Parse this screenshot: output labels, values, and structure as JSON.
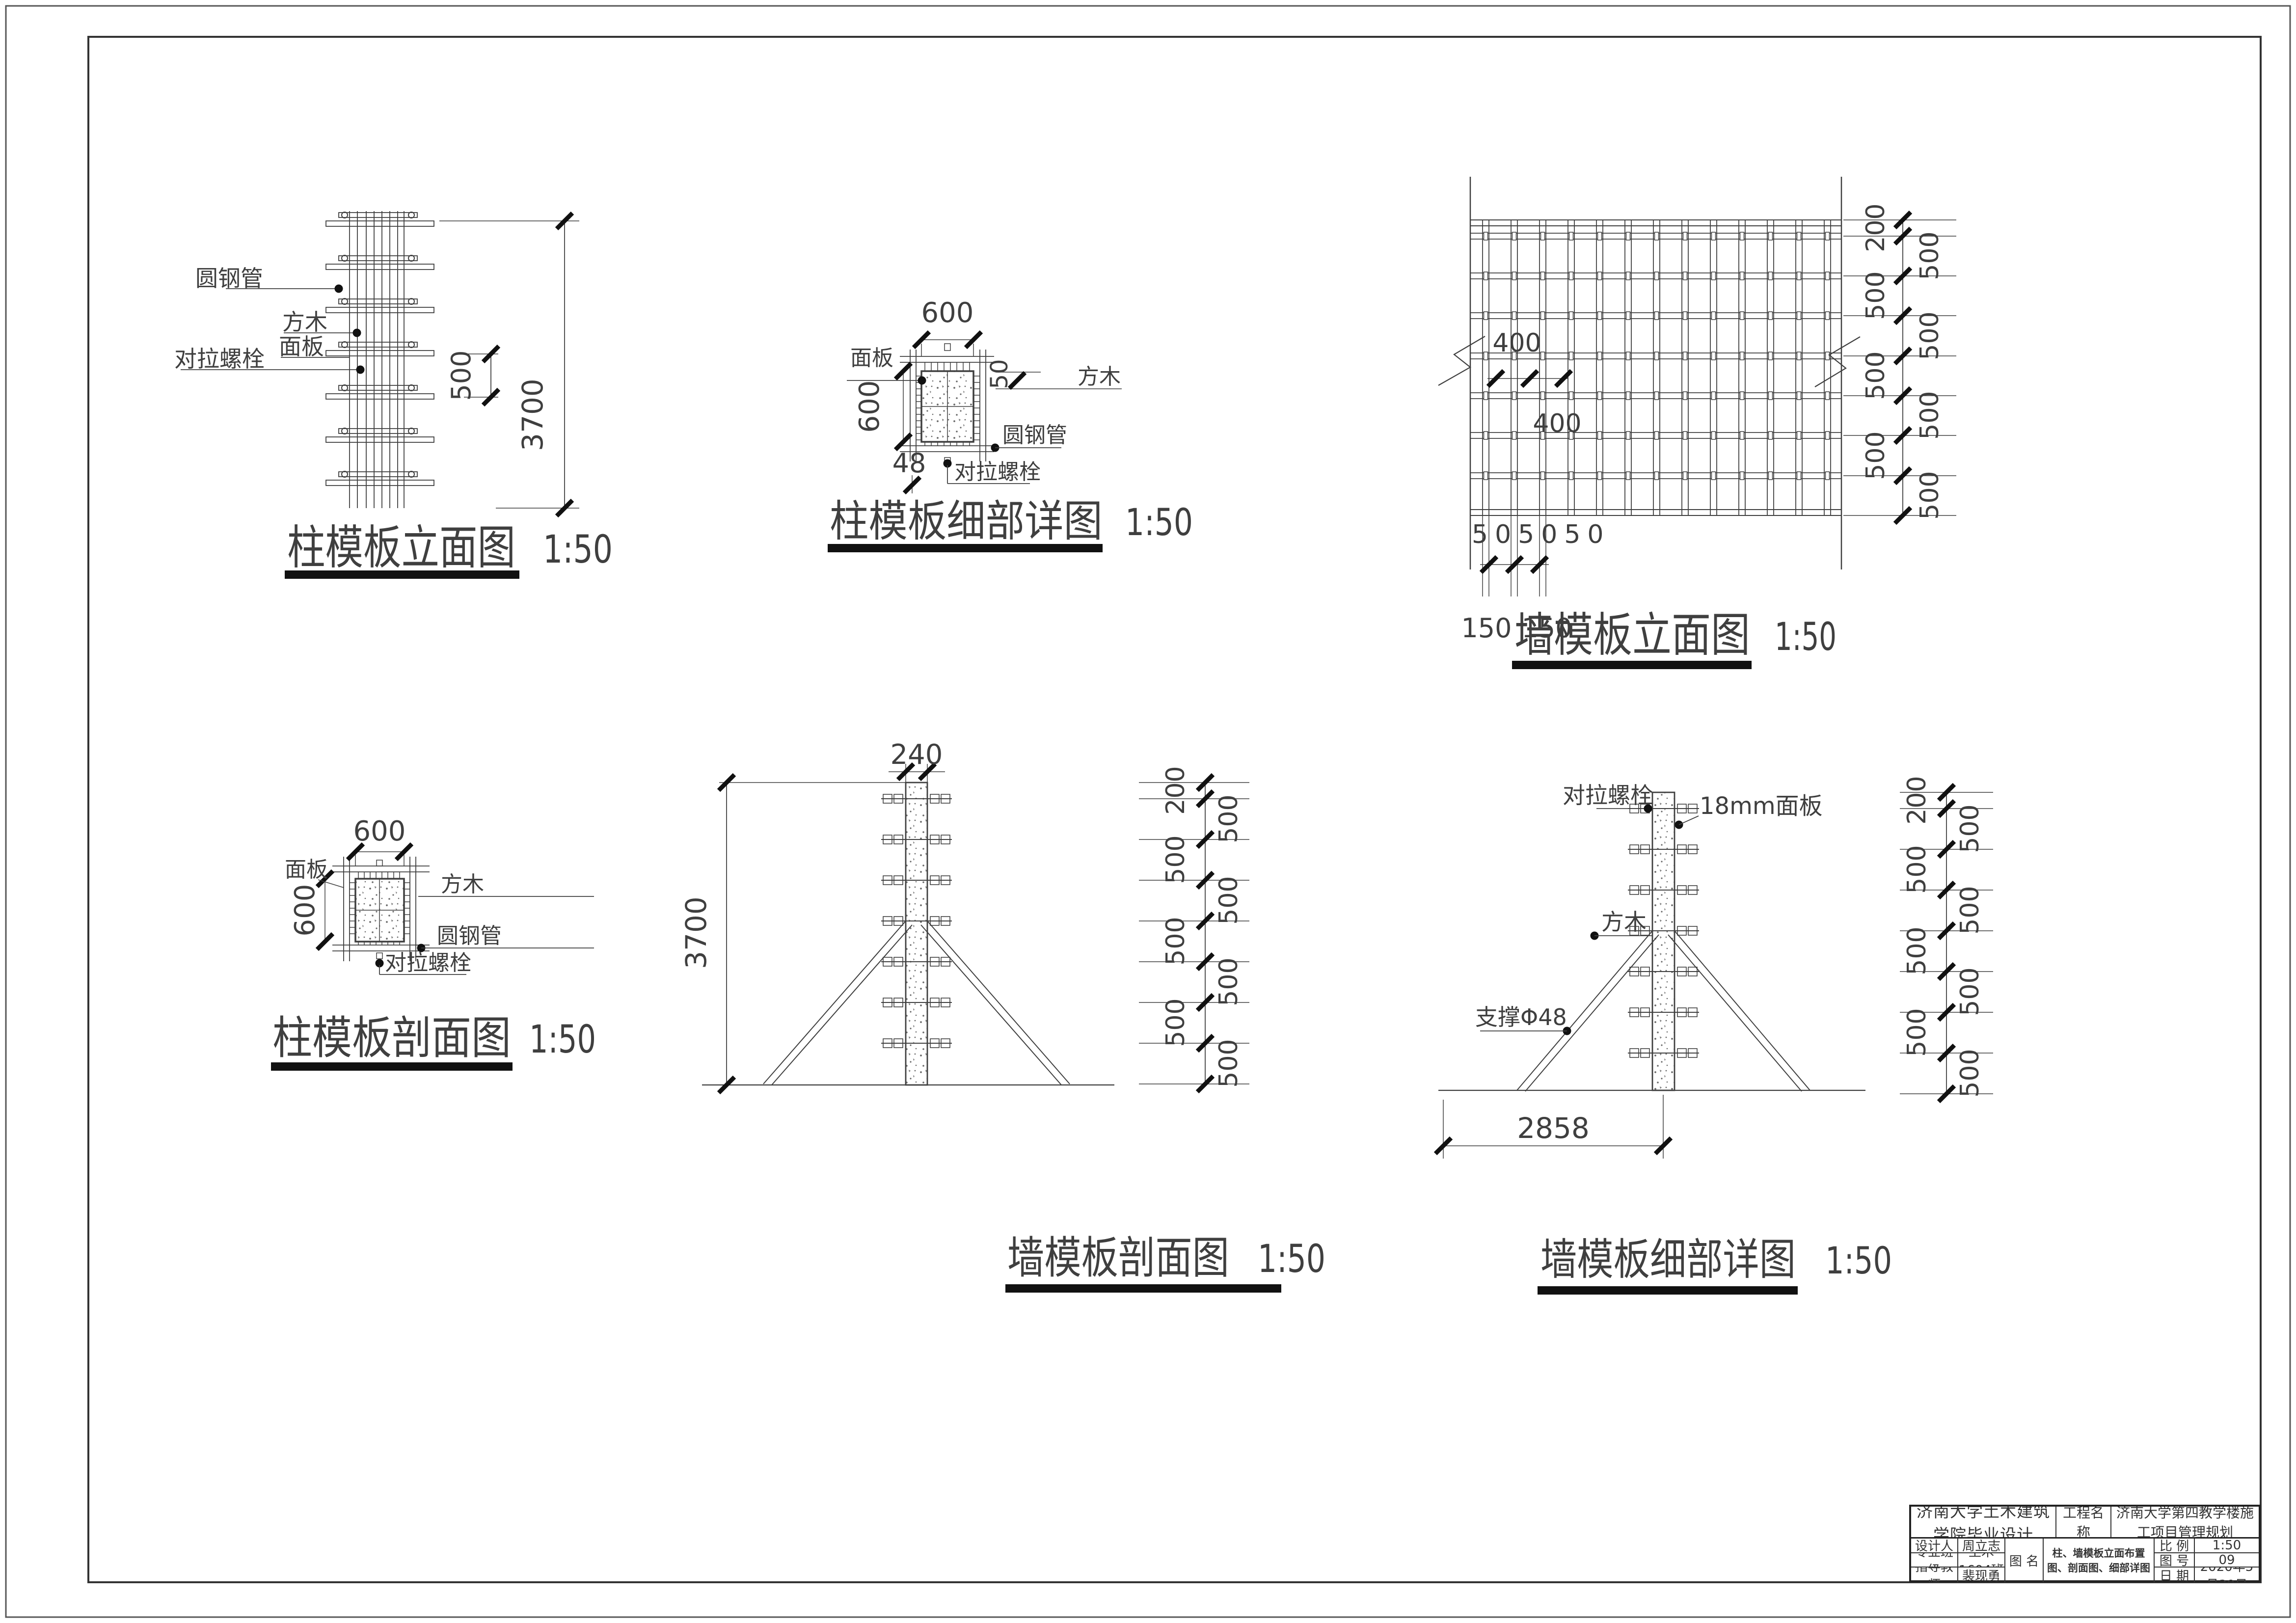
{
  "drawing": {
    "views": {
      "column_elevation": {
        "title": "柱模板立面图",
        "scale": "1:50"
      },
      "column_detail": {
        "title": "柱模板细部详图",
        "scale": "1:50"
      },
      "wall_elevation": {
        "title": "墙模板立面图",
        "scale": "1:50"
      },
      "column_section": {
        "title": "柱模板剖面图",
        "scale": "1:50"
      },
      "wall_section": {
        "title": "墙模板剖面图",
        "scale": "1:50"
      },
      "wall_detail": {
        "title": "墙模板细部详图",
        "scale": "1:50"
      }
    },
    "labels": {
      "round_steel_pipe": "圆钢管",
      "square_timber": "方木",
      "panel": "面板",
      "tie_bolt": "对拉螺栓",
      "panel_18mm": "18mm面板",
      "brace_phi48": "支撑Φ48"
    },
    "dims": {
      "d48": "48",
      "d50": "50",
      "d50x3": "505050",
      "d150": "150",
      "d200": "200",
      "d240": "240",
      "d400": "400",
      "d500": "500",
      "d600": "600",
      "d2858": "2858",
      "d3700": "3700"
    }
  },
  "title_block": {
    "university": "济南大学土木建筑学院毕业设计",
    "project_label": "工程名称",
    "project_name": "济南大学第四教学楼施工项目管理规划",
    "designer_label": "设计人",
    "designer": "周立志",
    "class_label": "专业班级",
    "class_value": "土木1604班",
    "advisor_label": "指导教师",
    "advisor": "裴现勇",
    "drawing_label": "图  名",
    "drawing_name": "柱、墙模板立面布置图、剖面图、细部详图",
    "scale_label": "比  例",
    "scale_value": "1:50",
    "no_label": "图  号",
    "no_value": "09",
    "date_label": "日  期",
    "date_value": "2020年5月30日"
  }
}
